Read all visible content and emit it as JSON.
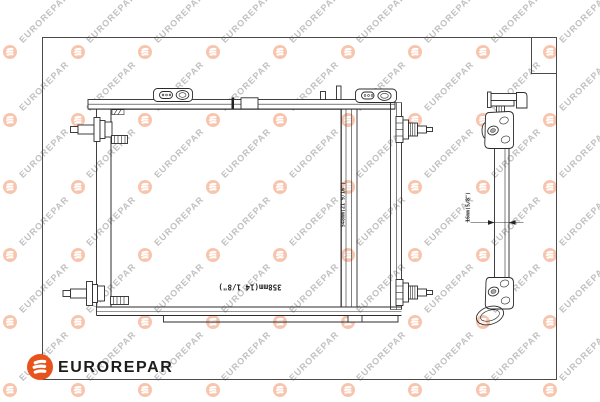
{
  "brand_footer": {
    "brand_name": "EUROREPAR",
    "logo_letter": "E",
    "logo_color": "#e8531c",
    "text_color": "#1d1d1b"
  },
  "watermark": {
    "brand_text": "EUROREPAR",
    "logo_letter": "E",
    "circle_color": "#ec6a2d",
    "circle_opacity": 0.38,
    "text_color": "#8e8e8e",
    "text_opacity": 0.55
  },
  "technical_drawing": {
    "front_view": {
      "height_dimension": "548mm(21 9/16\")",
      "width_dimension": "358mm(14 1/8\")"
    },
    "side_view": {
      "depth_dimension": "16mm(5/8\")"
    }
  }
}
